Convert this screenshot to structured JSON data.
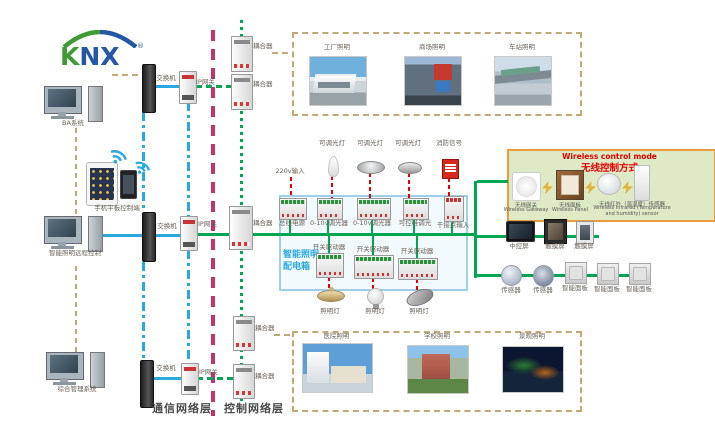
{
  "logo": {
    "k": "K",
    "nx": "NX",
    "reg": "®"
  },
  "stations": {
    "pc_top_label": "BA系统",
    "mobile_label": "手机平板控制端",
    "pc_mid_label": "智能照明远程控制",
    "pc_bottom_label": "综合管理系统"
  },
  "network": {
    "switch_label": "交换机",
    "gateway_label": "IP网关",
    "coupler_label": "耦合器",
    "comm_layer_label": "通信网络层",
    "ctrl_layer_label": "控制网络层"
  },
  "scenes": {
    "top": [
      "工厂照明",
      "商场照明",
      "车站照明"
    ],
    "bottom": [
      "医院照明",
      "学校照明",
      "景观照明"
    ]
  },
  "distribution_box": {
    "title_line1": "智能照明",
    "title_line2": "配电箱",
    "power_input_label": "220v输入",
    "load_labels": [
      "可调光灯",
      "可调光灯",
      "可调光灯",
      "消防信号"
    ],
    "device_labels": [
      "总线电源",
      "0-10v调光器",
      "0-10v调光器",
      "可控硅调光",
      "干接点输入"
    ],
    "actuator_labels": [
      "开关驱动器",
      "开关驱动器",
      "开关驱动器"
    ],
    "lamp_labels": [
      "照明灯",
      "照明灯",
      "照明灯"
    ]
  },
  "wireless_box": {
    "title_en": "Wireless control mode",
    "title_zh": "无线控制方式",
    "devices": [
      {
        "zh": "无线网关",
        "en": "Wireless Gateway"
      },
      {
        "zh": "无线面板",
        "en": "Wireless Panel"
      },
      {
        "zh": "无线红外（温湿度）传感器",
        "en": "Wireless infrared (Temperature and humidity) sensor"
      }
    ]
  },
  "right_devices": {
    "screen_labels": [
      "中控屏",
      "触摸屏",
      "触摸屏"
    ],
    "sensor_labels": [
      "传感器",
      "传感器"
    ],
    "panel_labels": [
      "智能面板",
      "智能面板",
      "智能面板"
    ]
  },
  "colors": {
    "bus_green": "#00A651",
    "ethernet_blue": "#2AA9E0",
    "layer_divider_magenta": "#C0336E",
    "aux_tan": "#C2A878",
    "load_red": "#E60000",
    "box_border_blue": "#9FD0E8",
    "box_title_blue": "#2AA9E0",
    "wireless_bg_green": "#DEEAC6",
    "wireless_border_orange": "#E89C3C",
    "wireless_title_red": "#E60000"
  }
}
